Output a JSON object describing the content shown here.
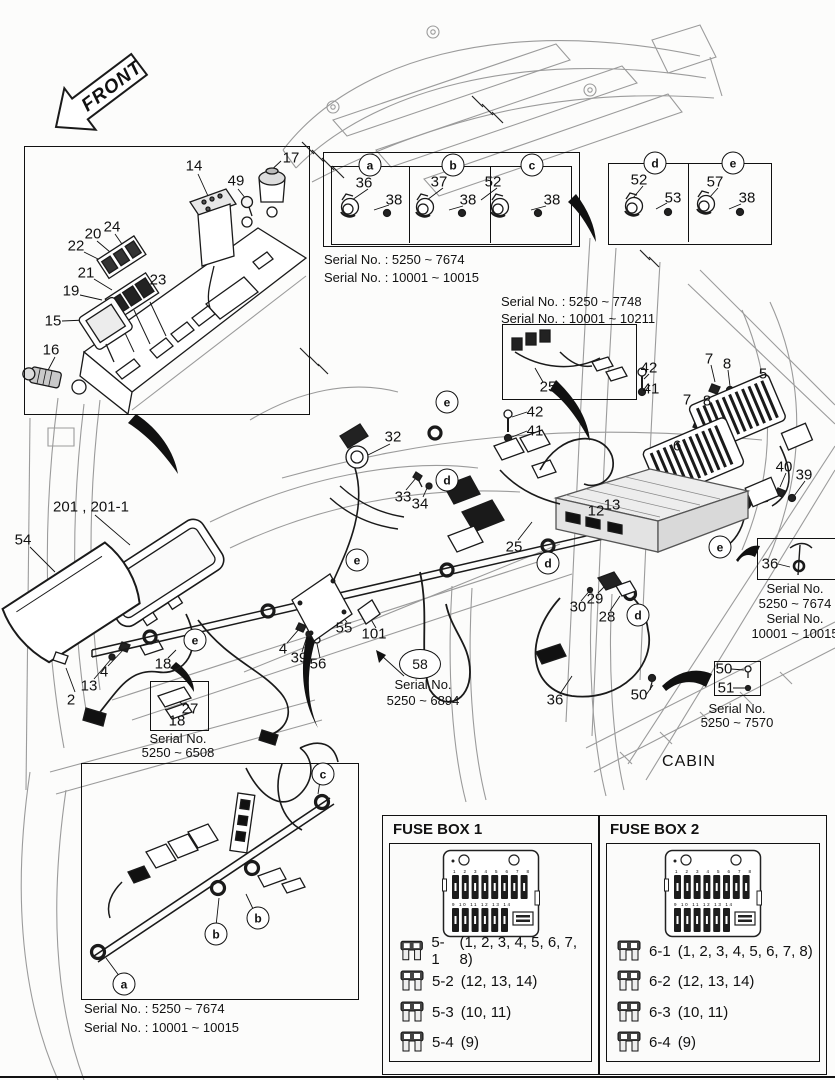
{
  "front_arrow": {
    "label": "FRONT"
  },
  "cabin_label": "CABIN",
  "serials": {
    "abc1": "Serial No. : 5250 ~ 7674",
    "abc2": "Serial No. : 10001 ~ 10015",
    "h25a": "Serial No. : 5250 ~ 7748",
    "h25b": "Serial No. : 10001 ~ 10211",
    "r36a": "Serial No.",
    "r36b": "5250 ~ 7674",
    "r36c": "Serial No.",
    "r36d": "10001 ~ 10015",
    "b5051a": "Serial No.",
    "b5051b": "5250 ~ 7570",
    "c27a": "Serial No.",
    "c27b": "5250 ~ 6508",
    "s58a": "Serial No.",
    "s58b": "5250 ~ 6894",
    "bot1": "Serial No. : 5250 ~ 7674",
    "bot2": "Serial No. : 10001 ~ 10015"
  },
  "callout_58": "58",
  "fuse_box_1": {
    "title": "FUSE BOX 1",
    "rows": [
      {
        "code": "5-1",
        "slots": "(1, 2, 3, 4, 5, 6, 7, 8)"
      },
      {
        "code": "5-2",
        "slots": "(12, 13, 14)"
      },
      {
        "code": "5-3",
        "slots": "(10, 11)"
      },
      {
        "code": "5-4",
        "slots": "(9)"
      }
    ]
  },
  "fuse_box_2": {
    "title": "FUSE BOX 2",
    "rows": [
      {
        "code": "6-1",
        "slots": "(1, 2, 3, 4, 5, 6, 7, 8)"
      },
      {
        "code": "6-2",
        "slots": "(12, 13, 14)"
      },
      {
        "code": "6-3",
        "slots": "(10, 11)"
      },
      {
        "code": "6-4",
        "slots": "(9)"
      }
    ]
  },
  "fuse_diagram": {
    "top_slots": "1 2 3 4 5 6 7 8",
    "bottom_slots": "9 10 11 12 13 14"
  },
  "part_labels": [
    {
      "text": "14",
      "x": 194,
      "y": 166
    },
    {
      "text": "49",
      "x": 236,
      "y": 181
    },
    {
      "text": "17",
      "x": 291,
      "y": 158
    },
    {
      "text": "24",
      "x": 112,
      "y": 227
    },
    {
      "text": "20",
      "x": 93,
      "y": 234
    },
    {
      "text": "22",
      "x": 76,
      "y": 246
    },
    {
      "text": "21",
      "x": 86,
      "y": 273
    },
    {
      "text": "19",
      "x": 71,
      "y": 291
    },
    {
      "text": "23",
      "x": 158,
      "y": 280
    },
    {
      "text": "15",
      "x": 53,
      "y": 321
    },
    {
      "text": "16",
      "x": 51,
      "y": 350
    },
    {
      "text": "36",
      "x": 364,
      "y": 183
    },
    {
      "text": "38",
      "x": 394,
      "y": 200
    },
    {
      "text": "37",
      "x": 439,
      "y": 182
    },
    {
      "text": "38",
      "x": 468,
      "y": 200
    },
    {
      "text": "52",
      "x": 493,
      "y": 182
    },
    {
      "text": "38",
      "x": 552,
      "y": 200
    },
    {
      "text": "52",
      "x": 639,
      "y": 180
    },
    {
      "text": "53",
      "x": 673,
      "y": 198
    },
    {
      "text": "57",
      "x": 715,
      "y": 182
    },
    {
      "text": "38",
      "x": 747,
      "y": 198
    },
    {
      "text": "201 , 201-1",
      "x": 91,
      "y": 507
    },
    {
      "text": "54",
      "x": 23,
      "y": 540
    },
    {
      "text": "4",
      "x": 104,
      "y": 672
    },
    {
      "text": "13",
      "x": 89,
      "y": 686
    },
    {
      "text": "2",
      "x": 71,
      "y": 700
    },
    {
      "text": "18",
      "x": 163,
      "y": 664
    },
    {
      "text": "32",
      "x": 393,
      "y": 437
    },
    {
      "text": "33",
      "x": 403,
      "y": 497
    },
    {
      "text": "34",
      "x": 420,
      "y": 504
    },
    {
      "text": "42",
      "x": 535,
      "y": 412
    },
    {
      "text": "41",
      "x": 535,
      "y": 431
    },
    {
      "text": "25",
      "x": 514,
      "y": 547
    },
    {
      "text": "12",
      "x": 596,
      "y": 511
    },
    {
      "text": "13",
      "x": 612,
      "y": 505
    },
    {
      "text": "42",
      "x": 649,
      "y": 368
    },
    {
      "text": "41",
      "x": 651,
      "y": 389
    },
    {
      "text": "7",
      "x": 709,
      "y": 359
    },
    {
      "text": "8",
      "x": 727,
      "y": 364
    },
    {
      "text": "5",
      "x": 763,
      "y": 374
    },
    {
      "text": "7",
      "x": 687,
      "y": 400
    },
    {
      "text": "8",
      "x": 707,
      "y": 401
    },
    {
      "text": "6",
      "x": 677,
      "y": 446
    },
    {
      "text": "40",
      "x": 784,
      "y": 467
    },
    {
      "text": "39",
      "x": 804,
      "y": 475
    },
    {
      "text": "55",
      "x": 344,
      "y": 628
    },
    {
      "text": "101",
      "x": 374,
      "y": 634
    },
    {
      "text": "4",
      "x": 283,
      "y": 649
    },
    {
      "text": "39",
      "x": 299,
      "y": 658
    },
    {
      "text": "56",
      "x": 318,
      "y": 664
    },
    {
      "text": "28",
      "x": 607,
      "y": 617
    },
    {
      "text": "29",
      "x": 595,
      "y": 599
    },
    {
      "text": "30",
      "x": 578,
      "y": 607
    },
    {
      "text": "36",
      "x": 555,
      "y": 700
    },
    {
      "text": "50",
      "x": 639,
      "y": 695
    },
    {
      "text": "25",
      "x": 548,
      "y": 387
    },
    {
      "text": "27",
      "x": 190,
      "y": 709
    },
    {
      "text": "18",
      "x": 177,
      "y": 721
    },
    {
      "text": "50",
      "x": 724,
      "y": 669
    },
    {
      "text": "51",
      "x": 726,
      "y": 688
    },
    {
      "text": "36",
      "x": 770,
      "y": 564
    }
  ],
  "circle_letters": [
    {
      "text": "a",
      "x": 370,
      "y": 165
    },
    {
      "text": "b",
      "x": 453,
      "y": 165
    },
    {
      "text": "c",
      "x": 532,
      "y": 165
    },
    {
      "text": "d",
      "x": 655,
      "y": 163
    },
    {
      "text": "e",
      "x": 733,
      "y": 163
    },
    {
      "text": "e",
      "x": 447,
      "y": 402
    },
    {
      "text": "d",
      "x": 447,
      "y": 480
    },
    {
      "text": "e",
      "x": 357,
      "y": 560
    },
    {
      "text": "d",
      "x": 548,
      "y": 563
    },
    {
      "text": "e",
      "x": 720,
      "y": 547
    },
    {
      "text": "d",
      "x": 638,
      "y": 615
    },
    {
      "text": "e",
      "x": 195,
      "y": 640
    },
    {
      "text": "c",
      "x": 323,
      "y": 774
    },
    {
      "text": "b",
      "x": 258,
      "y": 918
    },
    {
      "text": "b",
      "x": 216,
      "y": 934
    },
    {
      "text": "a",
      "x": 124,
      "y": 984
    }
  ]
}
